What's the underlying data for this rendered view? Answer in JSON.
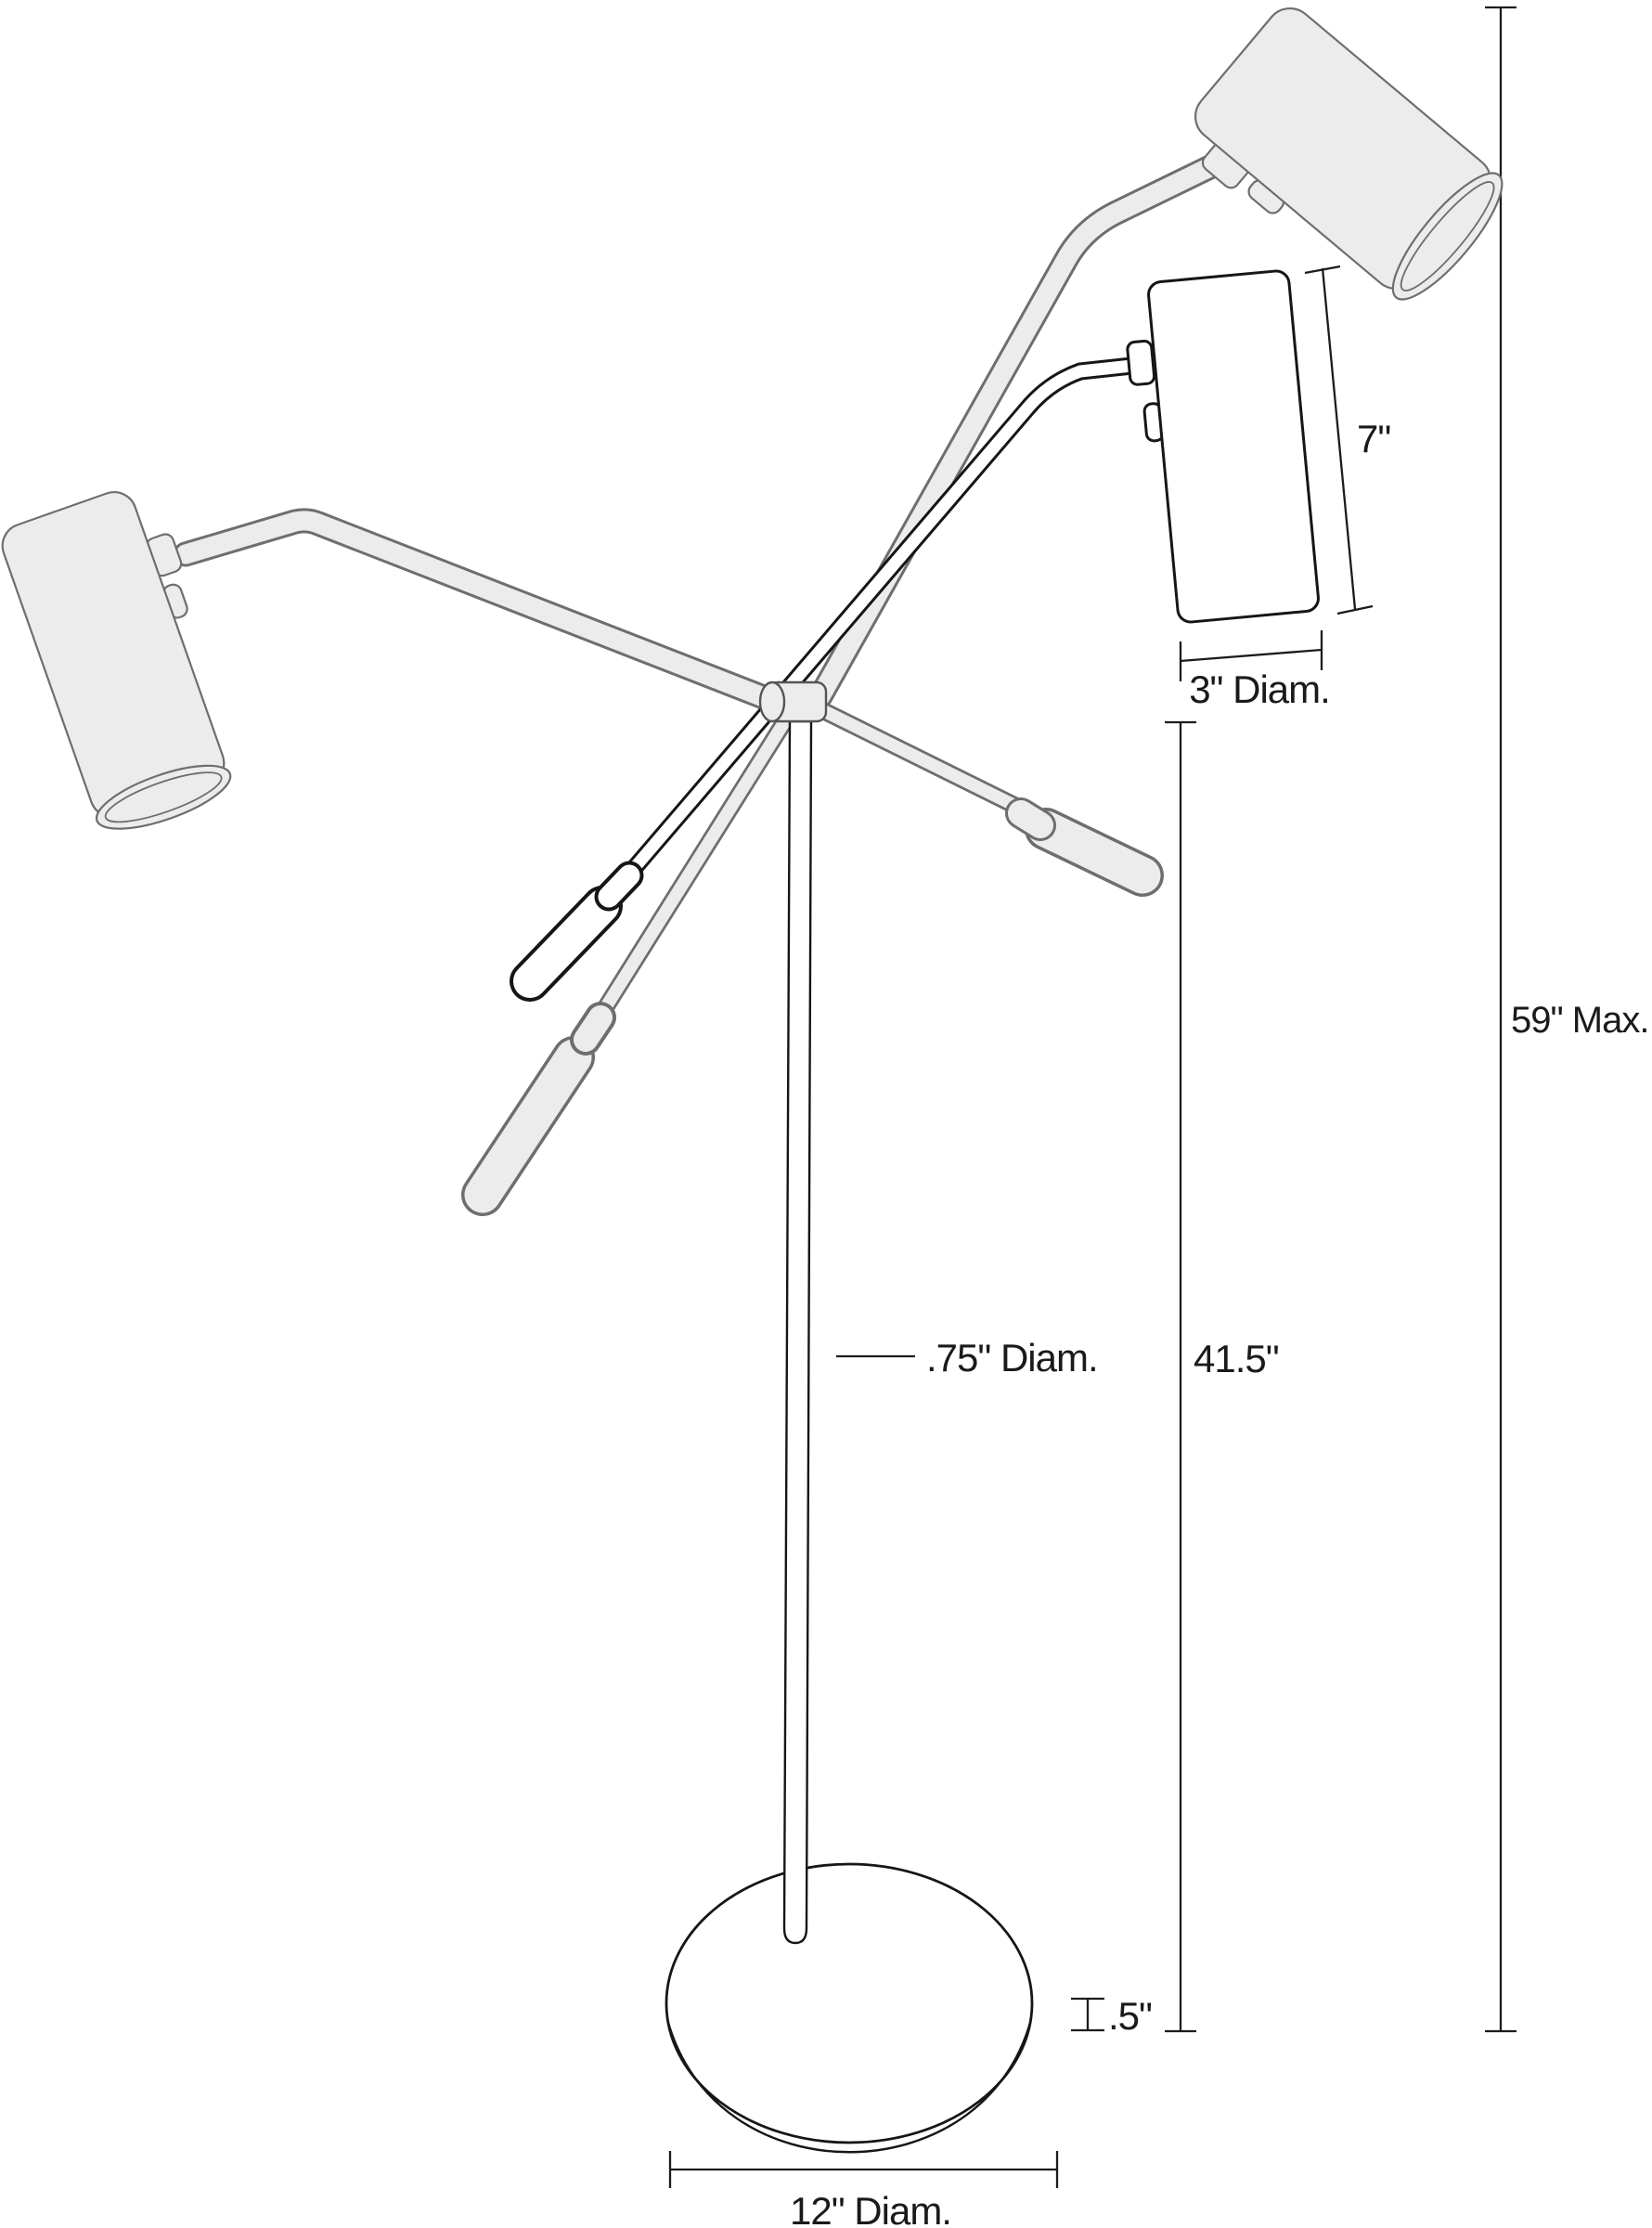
{
  "document": {
    "type": "technical-dimension-drawing",
    "subject": "floor lamp with three adjustable cylinder heads, pivot hub, pole and round base"
  },
  "colors": {
    "background": "#ffffff",
    "grey_fill": "#ececec",
    "grey_stroke": "#6e6e6e",
    "dark_stroke": "#161616",
    "dimension_line": "#1c1c1c",
    "dimension_text": "#1a1a1a"
  },
  "labels": {
    "shade_height": "7\"",
    "shade_diameter": "3\" Diam.",
    "overall_max_height": "59\" Max.",
    "pole_height": "41.5\"",
    "pole_diameter": ".75\" Diam.",
    "base_thickness": ".5\"",
    "base_diameter": "12\" Diam."
  }
}
